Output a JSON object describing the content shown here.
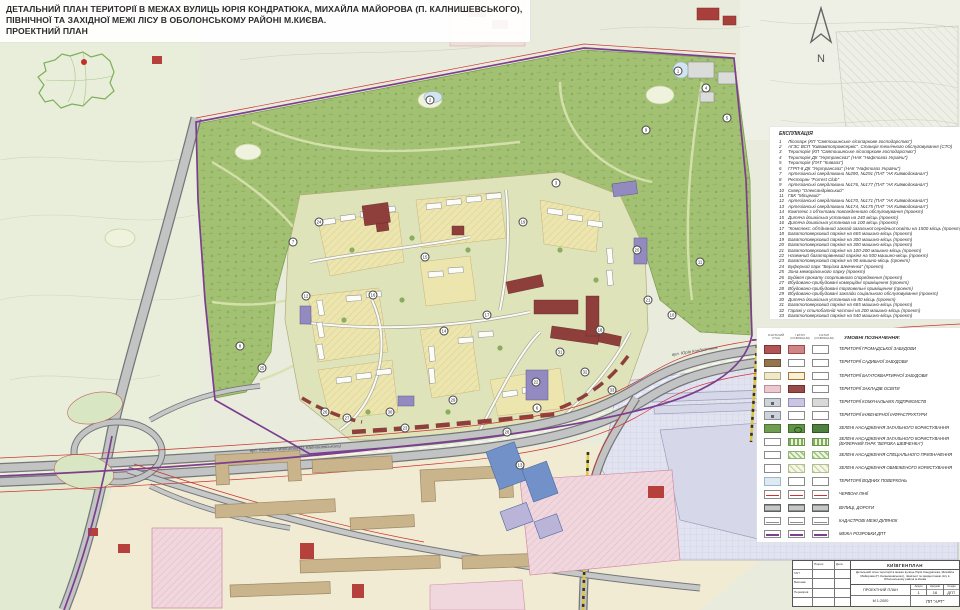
{
  "title": {
    "line1": "ДЕТАЛЬНИЙ ПЛАН ТЕРИТОРІЇ В МЕЖАХ ВУЛИЦЬ ЮРІЯ КОНДРАТЮКА, МИХАЙЛА МАЙОРОВА (П. КАЛНИШЕВСЬКОГО),",
    "line2": "ПІВНІЧНОЇ ТА ЗАХІДНОЇ МЕЖІ ЛІСУ В ОБОЛОНСЬКОМУ РАЙОНІ М.КИЄВА.",
    "line3": "ПРОЕКТНИЙ ПЛАН"
  },
  "north_label": "N",
  "explication": {
    "heading": "ЕКСПЛІКАЦІЯ",
    "items": [
      {
        "num": "1",
        "text": "Лісопарк (КП \"Святошинське лісопаркове господарство\")"
      },
      {
        "num": "2",
        "text": "АГЗС ВСП \"Київавтопромсервіс\". Станція технічного обслуговування (СТО)"
      },
      {
        "num": "3",
        "text": "Територія (КП \"Святошинське лісопаркове господарство\")"
      },
      {
        "num": "4",
        "text": "Територія ДК \"Укртрансгаз\" (НАК \"Нафтогаз України\")"
      },
      {
        "num": "5",
        "text": "Територія (ПАТ \"Київгаз\")"
      },
      {
        "num": "6",
        "text": "ГГРП-8 ДК \"Укртрансгаз\" (НАК \"Нафтогаз України\")"
      },
      {
        "num": "7",
        "text": "Артезіанські свердловини №290, №291 (ПАТ \"АК Київводоканал\")"
      },
      {
        "num": "8",
        "text": "Ресторан \"Forrest Club\""
      },
      {
        "num": "9",
        "text": "Артезіанські свердловини №176, №177 (ПАТ \"АК Київводоканал\")"
      },
      {
        "num": "10",
        "text": "Сквер \"Олександрівський\""
      },
      {
        "num": "11",
        "text": "ГБК \"Місцевий\""
      },
      {
        "num": "12",
        "text": "Артезіанські свердловини №170, №171 (ПАТ \"АК Київводоканал\")"
      },
      {
        "num": "13",
        "text": "Артезіанські свердловини №174, №175 (ПАТ \"АК Київводоканал\")"
      },
      {
        "num": "14",
        "text": "Комплекс з об'єктами повсякденного обслуговування (проект)"
      },
      {
        "num": "15",
        "text": "Дитяча дошкільна установа на 240 місць (проект)"
      },
      {
        "num": "16",
        "text": "Дитяча дошкільна установа на 100 місць (проект)"
      },
      {
        "num": "17",
        "text": "\"Комплекс: об'єднаний заклад загальної середньої освіти на 1500 місць (проект)\""
      },
      {
        "num": "18",
        "text": "Багатоповерховий паркінг на 665 машино-місць (проект)"
      },
      {
        "num": "19",
        "text": "Багатоповерховий паркінг на 300 машино-місць (проект)"
      },
      {
        "num": "20",
        "text": "Багатоповерховий паркінг на 300 машино-місць (проект)"
      },
      {
        "num": "21",
        "text": "Багатоповерховий паркінг на 100-200 машино-місць (проект)"
      },
      {
        "num": "22",
        "text": "Наземний багаторівневий паркінг на 500 машино-місць (проект)"
      },
      {
        "num": "23",
        "text": "Багатоповерховий паркінг на 90 машино-місць (проект)"
      },
      {
        "num": "24",
        "text": "Буферний парк \"Берізка Шевченка\" (проект)"
      },
      {
        "num": "25",
        "text": "Зона меморіального парку (проект)"
      },
      {
        "num": "26",
        "text": "Будівля прокату спортивного спорядження (проект)"
      },
      {
        "num": "27",
        "text": "Вбудовано-прибудовані комерційні приміщення (проект)"
      },
      {
        "num": "28",
        "text": "Вбудовано-прибудовані торговельні приміщення (проект)"
      },
      {
        "num": "29",
        "text": "Вбудовано-прибудовані заклади соціального обслуговування (проект)"
      },
      {
        "num": "30",
        "text": "Дитяча дошкільна установа на 80 місць (проект)"
      },
      {
        "num": "31",
        "text": "Багатоповерховий паркінг на 665 машино-місць (проект)"
      },
      {
        "num": "32",
        "text": "Гаражі у стилобатній частині на 200 машино-місць (проект)"
      },
      {
        "num": "33",
        "text": "Багатоповерховий паркінг на 540 машино-місць (проект)"
      }
    ]
  },
  "legend": {
    "heading": "УМОВНІ ПОЗНАЧЕННЯ:",
    "column_heads": [
      "ІСНУЮЧИЙ СТАН",
      "І ЕТАП (ОСВОЄННЯ)",
      "ІІ ЕТАП (ОСВОЄННЯ)"
    ],
    "rows": [
      {
        "label": "ТЕРИТОРІЇ ГРОМАДСЬКОЇ ЗАБУДОВИ",
        "swatches": [
          "sw-red-ex",
          "sw-red-1",
          "sw"
        ]
      },
      {
        "label": "ТЕРИТОРІЇ САДИБНОЇ ЗАБУДОВИ",
        "swatches": [
          "sw-brown",
          "sw",
          "sw"
        ]
      },
      {
        "label": "ТЕРИТОРІЇ БАГАТОКВАРТИРНОЇ ЗАБУДОВИ",
        "swatches": [
          "sw-cream",
          "sw-cream-o",
          "sw"
        ]
      },
      {
        "label": "ТЕРИТОРІЇ ЗАКЛАДІВ ОСВІТИ",
        "swatches": [
          "sw-pink",
          "sw-darkred",
          "sw"
        ]
      },
      {
        "label": "ТЕРИТОРІЇ КОМУНАЛЬНИХ ПІДПРИЄМСТВ",
        "swatches": [
          "sw-greyblue",
          "sw-lavender",
          "sw-grey"
        ]
      },
      {
        "label": "ТЕРИТОРІЇ ІНЖЕНЕРНОЇ ІНФРАСТРУКТУРИ",
        "swatches": [
          "sw-greyblue",
          "sw",
          "sw"
        ]
      },
      {
        "label": "ЗЕЛЕНІ НАСАДЖЕННЯ ЗАГАЛЬНОГО КОРИСТУВАННЯ",
        "swatches": [
          "sw-green",
          "sw-green2",
          "sw-green3"
        ]
      },
      {
        "label": "ЗЕЛЕНІ НАСАДЖЕННЯ ЗАГАЛЬНОГО КОРИСТУВАННЯ (БУФЕРНИЙ ПАРК \"БЕРІЗКА ШЕВЧЕНКА\")",
        "swatches": [
          "sw",
          "sw-stripe",
          "sw-stripe"
        ]
      },
      {
        "label": "ЗЕЛЕНІ НАСАДЖЕННЯ СПЕЦІАЛЬНОГО ПРИЗНАЧЕННЯ",
        "swatches": [
          "sw",
          "sw-hatch1",
          "sw-hatch1"
        ]
      },
      {
        "label": "ЗЕЛЕНІ НАСАДЖЕННЯ ОБМЕЖЕНОГО КОРИСТУВАННЯ",
        "swatches": [
          "sw",
          "sw-hatch2",
          "sw-hatch2"
        ]
      },
      {
        "label": "ТЕРИТОРІЇ ВОДНИХ ПОВЕРХОНЬ",
        "swatches": [
          "sw-water",
          "sw",
          "sw"
        ]
      },
      {
        "label": "ЧЕРВОНІ ЛІНІЇ",
        "swatches": [
          "sw-redline",
          "sw-redline",
          "sw-redline"
        ]
      },
      {
        "label": "ВУЛИЦІ, ДОРОГИ",
        "swatches": [
          "sw-road",
          "sw-road",
          "sw-road"
        ]
      },
      {
        "label": "КАДАСТРОВІ МЕЖІ ДІЛЯНОК",
        "swatches": [
          "sw-cad",
          "sw-cad",
          "sw-cad"
        ]
      },
      {
        "label": "МЕЖА РОЗРОБКИ ДПТ",
        "swatches": [
          "sw-dpt",
          "sw-dpt",
          "sw-dpt"
        ]
      }
    ]
  },
  "stamp": {
    "org": "КИЇВГЕНПЛАН",
    "doc_title": "Детальний план території в межах вулиць Юрія Кондратюка, Михайла Майорова (П. Калнишевського), північної та західної межі лісу в Оболонському районі м.Києва",
    "sheet_name": "ПРОЕКТНИЙ ПЛАН",
    "scale": "М 1:2000",
    "firm": "ПП \"АРТ\"",
    "cols": [
      {
        "head": "Аркуш",
        "val": "1"
      },
      {
        "head": "Аркушів",
        "val": "16"
      },
      {
        "head": "Стадія",
        "val": "ДПТ"
      }
    ],
    "left_rows": [
      "ГАП",
      "Виконав",
      "Перевірив"
    ],
    "left_heads": [
      "Підпис",
      "Дата"
    ]
  },
  "road_labels": [
    {
      "text": "вул. Михайла Майорова (П. Калнишевського)",
      "x": 250,
      "y": 448,
      "rot": -3
    },
    {
      "text": "вул. Юрія Кондратюка",
      "x": 672,
      "y": 352,
      "rot": -9
    }
  ],
  "map_markers": [
    {
      "n": "1",
      "x": 678,
      "y": 71
    },
    {
      "n": "2",
      "x": 430,
      "y": 100
    },
    {
      "n": "3",
      "x": 556,
      "y": 183
    },
    {
      "n": "4",
      "x": 706,
      "y": 88
    },
    {
      "n": "5",
      "x": 727,
      "y": 118
    },
    {
      "n": "6",
      "x": 537,
      "y": 408
    },
    {
      "n": "7",
      "x": 293,
      "y": 242
    },
    {
      "n": "8",
      "x": 240,
      "y": 346
    },
    {
      "n": "9",
      "x": 646,
      "y": 130
    },
    {
      "n": "10",
      "x": 672,
      "y": 315
    },
    {
      "n": "11",
      "x": 700,
      "y": 262
    },
    {
      "n": "12",
      "x": 306,
      "y": 296
    },
    {
      "n": "13",
      "x": 520,
      "y": 465
    },
    {
      "n": "14",
      "x": 444,
      "y": 331
    },
    {
      "n": "15",
      "x": 425,
      "y": 257
    },
    {
      "n": "16",
      "x": 373,
      "y": 295
    },
    {
      "n": "17",
      "x": 487,
      "y": 315
    },
    {
      "n": "18",
      "x": 600,
      "y": 330
    },
    {
      "n": "19",
      "x": 523,
      "y": 222
    },
    {
      "n": "20",
      "x": 637,
      "y": 250
    },
    {
      "n": "21",
      "x": 648,
      "y": 300
    },
    {
      "n": "22",
      "x": 536,
      "y": 382
    },
    {
      "n": "23",
      "x": 405,
      "y": 428
    },
    {
      "n": "24",
      "x": 319,
      "y": 222
    },
    {
      "n": "25",
      "x": 262,
      "y": 368
    },
    {
      "n": "26",
      "x": 325,
      "y": 412
    },
    {
      "n": "27",
      "x": 347,
      "y": 418
    },
    {
      "n": "28",
      "x": 507,
      "y": 432
    },
    {
      "n": "29",
      "x": 453,
      "y": 400
    },
    {
      "n": "30",
      "x": 390,
      "y": 412
    },
    {
      "n": "31",
      "x": 560,
      "y": 352
    },
    {
      "n": "32",
      "x": 585,
      "y": 372
    },
    {
      "n": "33",
      "x": 612,
      "y": 390
    }
  ],
  "colors": {
    "forest": "#a3c173",
    "development": "#dfe3ba",
    "block_yellow": "#ece5ad",
    "public_red": "#8e3f3b",
    "parking_purple": "#938ac0",
    "road": "#c2c4c4",
    "existing_cream": "#f2ebd3",
    "existing_tan": "#c9b48c",
    "industrial": "#e2e3f0",
    "water": "#d3e4ef",
    "dpt_boundary": "#7c3e8f",
    "red_line": "#cc3333",
    "rail": "#dec63e"
  }
}
